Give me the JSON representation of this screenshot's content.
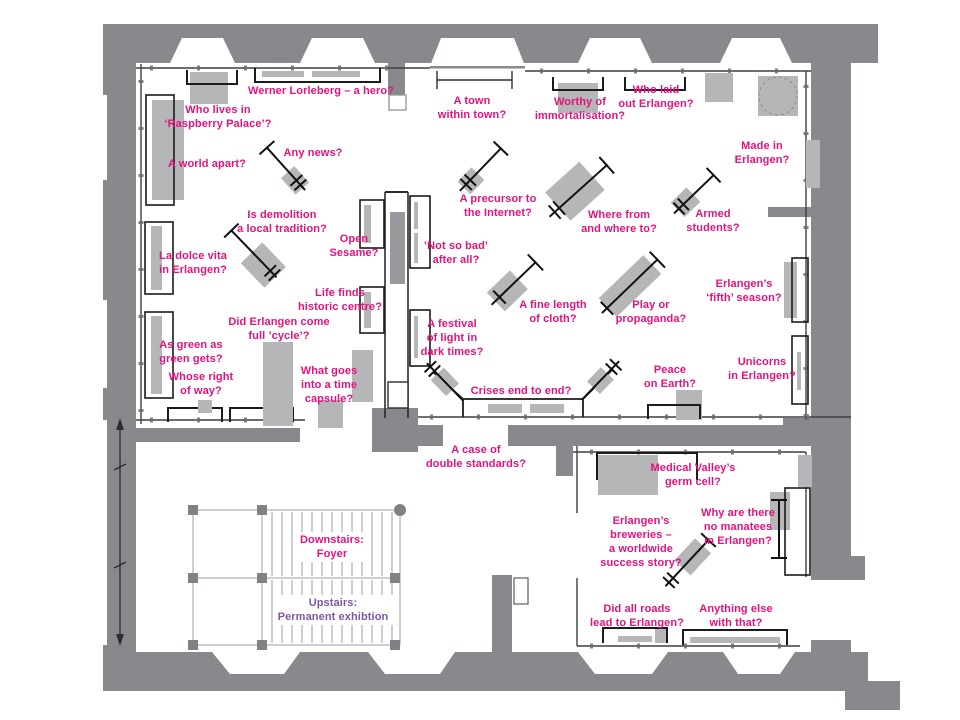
{
  "colors": {
    "wall": "#87898c",
    "furniture": "#b4b6b8",
    "furniture_dark": "#97999c",
    "label_pink": "#e5117f",
    "label_purple": "#7d57a5"
  },
  "labels": [
    {
      "name": "label-werner-lorleberg",
      "x": 321,
      "y": 91,
      "lines": [
        "Werner Lorleberg – a hero?"
      ]
    },
    {
      "name": "label-raspberry-palace",
      "x": 218,
      "y": 117,
      "lines": [
        "Who lives in",
        "‘Raspberry Palace’?"
      ]
    },
    {
      "name": "label-world-apart",
      "x": 207,
      "y": 164,
      "lines": [
        "A world apart?"
      ]
    },
    {
      "name": "label-any-news",
      "x": 313,
      "y": 153,
      "lines": [
        "Any news?"
      ]
    },
    {
      "name": "label-town-within-town",
      "x": 472,
      "y": 108,
      "lines": [
        "A town",
        "within town?"
      ]
    },
    {
      "name": "label-worthy-immortalisation",
      "x": 580,
      "y": 109,
      "lines": [
        "Worthy of",
        "immortalisation?"
      ]
    },
    {
      "name": "label-who-laid-out",
      "x": 656,
      "y": 97,
      "lines": [
        "Who laid",
        "out Erlangen?"
      ]
    },
    {
      "name": "label-made-in-erlangen",
      "x": 762,
      "y": 153,
      "lines": [
        "Made in",
        "Erlangen?"
      ]
    },
    {
      "name": "label-precursor-internet",
      "x": 498,
      "y": 206,
      "lines": [
        "A precursor to",
        "the Internet?"
      ]
    },
    {
      "name": "label-where-from",
      "x": 619,
      "y": 222,
      "lines": [
        "Where from",
        "and where to?"
      ]
    },
    {
      "name": "label-armed-students",
      "x": 713,
      "y": 221,
      "lines": [
        "Armed",
        "students?"
      ]
    },
    {
      "name": "label-demolition",
      "x": 282,
      "y": 222,
      "lines": [
        "Is demolition",
        "a local tradition?"
      ]
    },
    {
      "name": "label-open-sesame",
      "x": 354,
      "y": 246,
      "lines": [
        "Open",
        "Sesame?"
      ]
    },
    {
      "name": "label-not-so-bad",
      "x": 456,
      "y": 253,
      "lines": [
        "’Not so bad’",
        "after all?"
      ]
    },
    {
      "name": "label-dolce-vita",
      "x": 193,
      "y": 263,
      "lines": [
        "La dolce vita",
        "in Erlangen?"
      ]
    },
    {
      "name": "label-life-finds",
      "x": 340,
      "y": 300,
      "lines": [
        "Life finds",
        "historic centre?"
      ]
    },
    {
      "name": "label-fine-length",
      "x": 553,
      "y": 312,
      "lines": [
        "A fine length",
        "of cloth?"
      ]
    },
    {
      "name": "label-play-propaganda",
      "x": 651,
      "y": 312,
      "lines": [
        "Play or",
        "propaganda?"
      ]
    },
    {
      "name": "label-fifth-season",
      "x": 744,
      "y": 291,
      "lines": [
        "Erlangen’s",
        "‘fifth’ season?"
      ]
    },
    {
      "name": "label-full-cycle",
      "x": 279,
      "y": 329,
      "lines": [
        "Did Erlangen come",
        "full ’cycle’?"
      ]
    },
    {
      "name": "label-festival-light",
      "x": 452,
      "y": 338,
      "lines": [
        "A festival",
        "of light in",
        "dark times?"
      ]
    },
    {
      "name": "label-green-as-green",
      "x": 191,
      "y": 352,
      "lines": [
        "As green as",
        "green gets?"
      ]
    },
    {
      "name": "label-whose-right",
      "x": 201,
      "y": 384,
      "lines": [
        "Whose right",
        "of way?"
      ]
    },
    {
      "name": "label-time-capsule",
      "x": 329,
      "y": 385,
      "lines": [
        "What goes",
        "into a time",
        "capsule?"
      ]
    },
    {
      "name": "label-crises",
      "x": 521,
      "y": 391,
      "lines": [
        "Crises end to end?"
      ]
    },
    {
      "name": "label-peace-earth",
      "x": 670,
      "y": 377,
      "lines": [
        "Peace",
        "on Earth?"
      ]
    },
    {
      "name": "label-unicorns",
      "x": 762,
      "y": 369,
      "lines": [
        "Unicorns",
        "in Erlangen?"
      ]
    },
    {
      "name": "label-double-standards",
      "x": 476,
      "y": 457,
      "lines": [
        "A case of",
        "double standards?"
      ]
    },
    {
      "name": "label-medical-valley",
      "x": 693,
      "y": 475,
      "lines": [
        "Medical Valley’s",
        "germ cell?"
      ]
    },
    {
      "name": "label-breweries",
      "x": 641,
      "y": 542,
      "lines": [
        "Erlangen’s",
        "breweries –",
        "a worldwide",
        "success story?"
      ]
    },
    {
      "name": "label-manatees",
      "x": 738,
      "y": 527,
      "lines": [
        "Why are there",
        "no manatees",
        "in Erlangen?"
      ]
    },
    {
      "name": "label-downstairs-foyer",
      "x": 332,
      "y": 547,
      "lines": [
        "Downstairs:",
        "Foyer"
      ],
      "bg": true
    },
    {
      "name": "label-upstairs-permanent",
      "x": 333,
      "y": 610,
      "lines": [
        "Upstairs:",
        "Permanent exhibtion"
      ],
      "color": "purple",
      "bg": true
    },
    {
      "name": "label-all-roads",
      "x": 637,
      "y": 616,
      "lines": [
        "Did all roads",
        "lead to Erlangen?"
      ]
    },
    {
      "name": "label-anything-else",
      "x": 736,
      "y": 616,
      "lines": [
        "Anything else",
        "with that?"
      ]
    }
  ]
}
